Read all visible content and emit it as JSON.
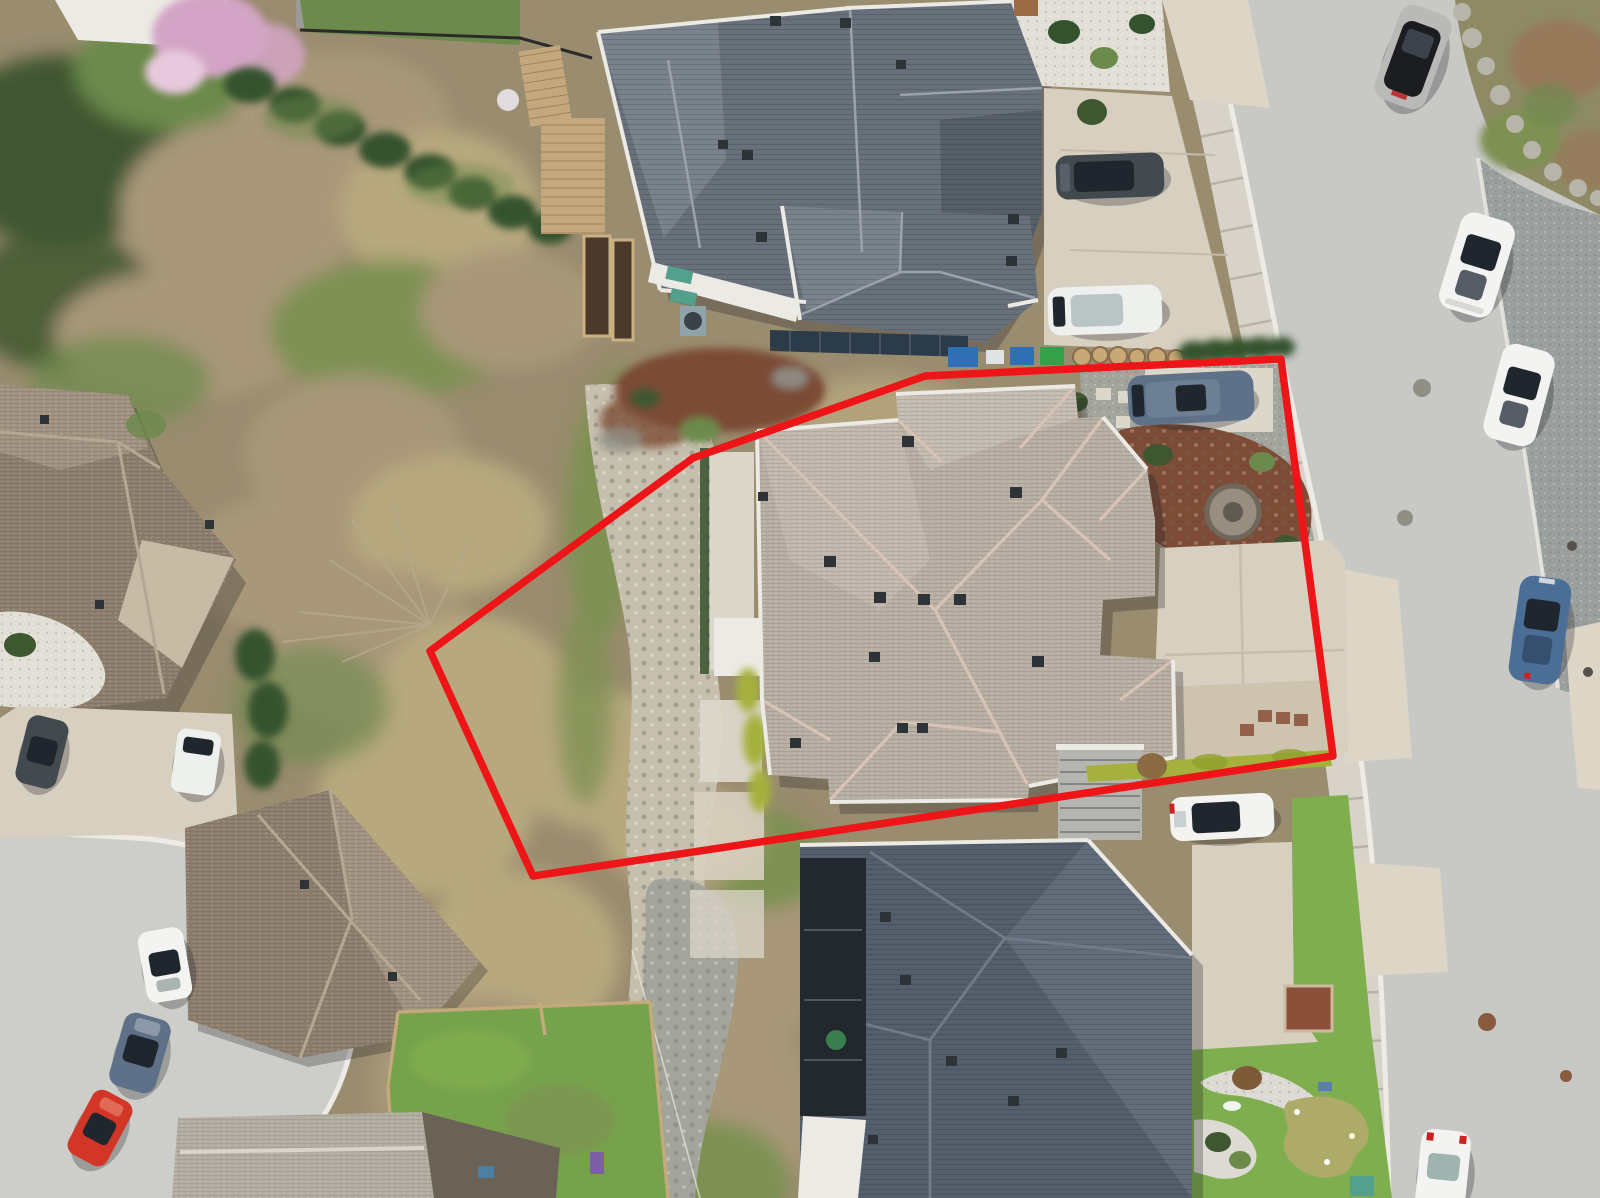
{
  "meta": {
    "description": "Aerial drone photograph of a residential lot outlined with a red property boundary, surrounded by neighbouring houses, a curving street with parked cars, a cul-de-sac and a brushy ravine."
  },
  "scene": {
    "boundary": "red-property-line",
    "subject": "beige-hip-roof-house",
    "neighbours": [
      "charcoal-roof-house-north",
      "navy-roof-house-south",
      "brown-roof-house-west",
      "brown-roof-house-southwest",
      "gray-roof-house-bottom"
    ],
    "vehicle_count": 13
  },
  "colors": {
    "boundary_red": "#ee1518",
    "road": "#c8c8c5",
    "road_cul": "#cdcdca",
    "sidewalk": "#d8d3c8",
    "seam": "#b8b3a8",
    "curb": "#edebe4",
    "apron": "#ddd5c6",
    "gravel_dark": "#9aa09e",
    "moss_bank": "#8d8a64",
    "moss_brown": "#97795a",
    "rock_light": "#b7b4aa",
    "white_rock": "#e2dfd7",
    "scrub_base": "#9a8c6f",
    "veg_dark": "#3f5730",
    "veg_mid": "#6c8a4c",
    "veg_moss": "#7e9152",
    "dry_grass": "#b7a87e",
    "twig": "#a89779",
    "rocky_band": "#c6bfae",
    "riprap": "#a3a49b",
    "stone": "#8f8f86",
    "mulch": "#7c4c36",
    "roof_dark": "#68707c",
    "roof_dark_lt": "#7a828e",
    "roof_dark_dk": "#565e6a",
    "roof_beige": "#b7aea3",
    "roof_beige_lt": "#c4bbb0",
    "ridge_pink": "#d8c2b4",
    "roof_navy": "#545f6d",
    "roof_navy_lt": "#626d7b",
    "roof_black": "#23282e",
    "roof_brown": "#8c7d6d",
    "roof_brown_lt": "#a09180",
    "roof_gray": "#b2ada1",
    "wall_white": "#eceae4",
    "band_tan": "#c7bba6",
    "deck_wood": "#c4a87d",
    "soil": "#4b3a2b",
    "solar": "#2c3b49",
    "lawn": "#76a24c",
    "lawn_bright": "#7fae4e",
    "putt": "#aeaa68",
    "hedge_lime": "#a4b13c",
    "hedge_dark": "#35522e",
    "driveway": "#d7cfc0",
    "pad": "#dcd7cb",
    "glass": "#20262e",
    "car_white": "#f3f4f2",
    "car_silver": "#b9bab7",
    "car_black": "#1b1d20",
    "car_blue": "#4b6e97",
    "car_slate": "#5e7188",
    "car_red": "#d23627",
    "car_dark": "#42494f",
    "van_white": "#eef0ee",
    "fence_wood": "#c3a97c",
    "purple": "#7e5fa3",
    "teal": "#53a08c",
    "fire_ring": "#978e80",
    "bin_blue": "#2f6fb4",
    "bin_green": "#33a04a",
    "bin_white": "#dfe3e6",
    "stump": "#c9a878",
    "putting_white": "#dcdad2",
    "garden_brown": "#8a5138",
    "pink_blossom": "#d3a4c6"
  }
}
